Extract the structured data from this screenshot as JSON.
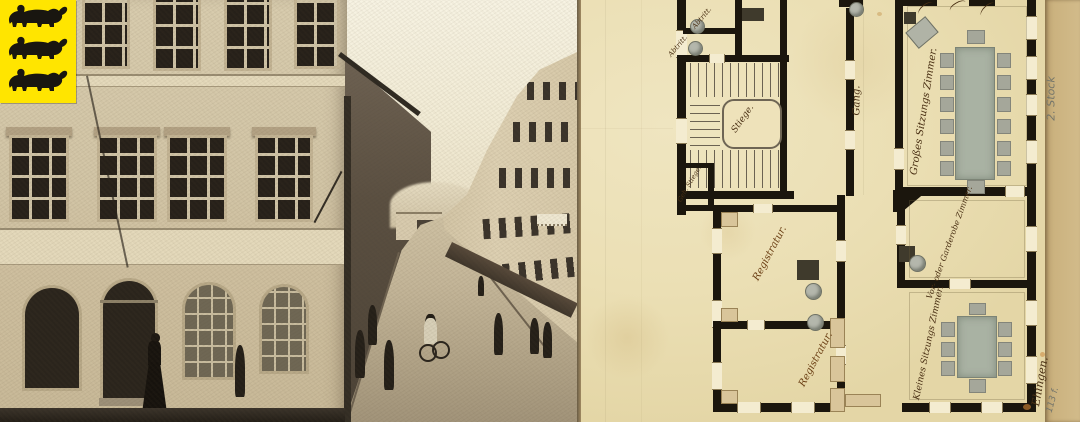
{
  "coat_of_arms": {
    "icon": "three-lions-coat-of-arms",
    "colors": {
      "field": "#ffe500",
      "lions": "#191610"
    }
  },
  "photo": {
    "subject": "historic-street-corner-photograph",
    "colors": {
      "sky": "#f5f0dd",
      "facade": "#d6c9ab",
      "street": "#c1b499",
      "shadow": "#4b4236"
    }
  },
  "plan": {
    "labels": {
      "abtritt_top": "Abtritt.",
      "abtritt_bottom": "Abtritt.",
      "stiege": "Stiege.",
      "geh_stiege": "Geh. Stiege.",
      "gang": "Gang.",
      "grosses_sitzungszimmer": "Großes Sitzungs Zimmer.",
      "vor_oder_garderobe_zimmer": "Vor- oder Garderobe Zimmer.",
      "kleines_sitzungszimmer": "Kleines Sitzungs Zimmer.",
      "registratur_upper": "Registratur.",
      "registratur_lower": "Registratur.",
      "floor_note": "2. Stock",
      "corner_inscription": "Ehingen.",
      "shelfmark": "113 f."
    },
    "furniture": {
      "grosses_sitzungszimmer": {
        "tables": 1,
        "chairs": 14
      },
      "kleines_sitzungszimmer": {
        "tables": 1,
        "chairs": 8
      }
    },
    "colors": {
      "paper": "#ebdfb4",
      "wall": "#1b160d",
      "ink": "#4a3014",
      "pencil": "#75766a",
      "furniture_wash": "#a9b2a3",
      "old_wall_tan": "#d9c59a"
    }
  }
}
